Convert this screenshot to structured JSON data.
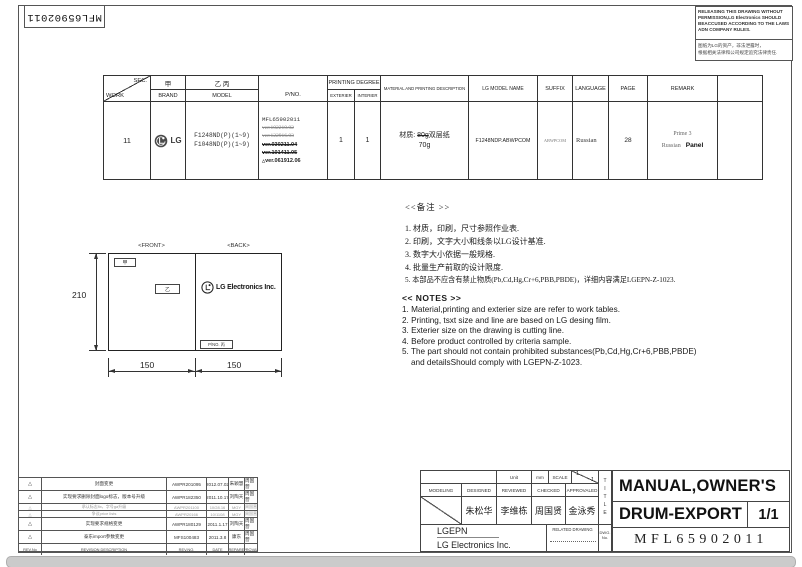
{
  "corner": {
    "pno": "MFL65902011"
  },
  "warning": {
    "english": "RELEASING THIS DRAWING WITHOUT PERMISSION,LG Electronics SHOULD BEACCUSED ACCORDING TO THE LAWS ADN COMPANY RULES.",
    "chinese_line1": "图纸为LG的资产，非法泄露时，",
    "chinese_line2": "根据相关法律和公司规定追究法律责任."
  },
  "work_table": {
    "headers": {
      "sec": "SEC.",
      "work": "WORK",
      "brand_cn": "甲",
      "brand": "BRAND",
      "model_cn": "乙 丙",
      "model": "MODEL",
      "pno": "P/NO.",
      "printing_degree": "PRINTING DEGREE",
      "exterier": "EXTERIER",
      "interier": "INTERIER",
      "material": "MATERIAL AND PRINTING DESCRIPTION",
      "lg_model_name": "LG MODEL NAME",
      "suffix": "SUFFIX",
      "language": "LANGUAGE",
      "page": "PAGE",
      "remark": "REMARK"
    },
    "row": {
      "work": "11",
      "brand": "LG",
      "model_1": "F1248ND(P)(1~9)",
      "model_2": "F1048ND(P)(1~9)",
      "pno": "MFL65902011",
      "versions": [
        {
          "text": "ver:102210.02",
          "struck": true
        },
        {
          "text": "ver:122916.03",
          "struck": true
        },
        {
          "text": "ver.030211.04",
          "struck": true
        },
        {
          "text": "ver.101411.05",
          "struck": true
        },
        {
          "text": "ver.061912.06",
          "struck": false,
          "prefix": "△"
        }
      ],
      "exterier": "1",
      "interier": "1",
      "material_label": "材质:",
      "material_struck": "80g",
      "material_text": "双层纸",
      "material_weight": "70g",
      "lg_model_name": "F1248NDP.ABWPCOM",
      "suffix": "ABWPCOM",
      "language": "Russian",
      "page": "28",
      "remark_line1": "Prime 3",
      "remark_line2_left": "Russian",
      "remark_line2_right": "Panel"
    }
  },
  "diagram": {
    "front_label": "<FRONT>",
    "back_label": "<BACK>",
    "jia": "甲",
    "yi": "乙",
    "logo_text": "LG Electronics Inc.",
    "pno_box": "P/NO. 丙",
    "dim_height": "210",
    "dim_left": "150",
    "dim_right": "150"
  },
  "notes_cn": {
    "title": "<<备注 >>",
    "items": [
      "1. 材质，印刷，尺寸参照作业表.",
      "2. 印刷，文字大小和线条以LG设计基准.",
      "3. 数字大小依据一般规格.",
      "4. 批量生产前取的设计限度.",
      "5. 本部品不应含有禁止物质(Pb,Cd,Hg,Cr+6,PBB,PBDE)，详细内容满足LGEPN-Z-1023."
    ]
  },
  "notes_en": {
    "title": "<< NOTES >>",
    "items": [
      "1. Material,printing and exterier size are refer to work tables.",
      "2. Printing, tsxt  size and line are based on LG desing film.",
      "3. Exterier size on the drawing is cutting line.",
      "4. Before product controlled by criteria sample.",
      "5. The part should not contain prohibited substances(Pb,Cd,Hg,Cr+6,PBB,PBDE)",
      "and detailsShould comply with LGEPN-Z-1023."
    ]
  },
  "revision_table": {
    "headers": {
      "rev_no_col": "REV.No",
      "description": "REVISION DESCRIPTION",
      "rev_no": "REV.NO.",
      "date": "DATE",
      "prepared": "PREPARED",
      "approvaled": "APPROVALED"
    },
    "rows": [
      {
        "sym": "△",
        "desc": "封面变更",
        "no": "AWPR201095",
        "date": "2012.07.02",
        "prep": "朱颖慧",
        "appr": "周国营"
      },
      {
        "sym": "△",
        "desc": "实现要求删除封面logo标志，版本号升级",
        "no": "AWPR182350",
        "date": "2011.10.17",
        "prep": "刘陶天",
        "appr": "周国营"
      },
      {
        "sym": "△",
        "desc": "承认标志fix，字号ga升级",
        "no": "AWPR201100",
        "date": "10/28.16",
        "prep": "MGY",
        "appr": "周国营"
      },
      {
        "sym": "△",
        "desc": "争议price lists",
        "no": "AWPR20166",
        "date": "10/1108",
        "prep": "MGY",
        "appr": "周国营"
      },
      {
        "sym": "△",
        "desc": "实现要求规格变更",
        "no": "AWPR180129",
        "date": "2011.1.17",
        "prep": "刘陶天",
        "appr": "周国营"
      },
      {
        "sym": "△",
        "desc": "泰东import参数变更",
        "no": "MFS100483",
        "date": "2011.3.8",
        "prep": "康东",
        "appr": "周国营"
      }
    ]
  },
  "title_block": {
    "unit_label": "Unit",
    "unit_value": "mm",
    "scale_label": "SCALE",
    "scale_num": "1",
    "scale_den": "1",
    "modeling": "MODELING",
    "designed": "DESIGNED",
    "reviewed": "REVIEWED",
    "checked": "CHECKED",
    "approvaled": "APPROVALED",
    "designed_name": "朱松华",
    "reviewed_name": "李维栋",
    "checked_name": "周国贤",
    "approvaled_name": "金泳秀",
    "company_short": "LGEPN",
    "company_full": "LG Electronics Inc.",
    "related_drawing": "RELATED DRAWING",
    "dwg_no": "DWG. No.",
    "title_vertical": "TITLE",
    "title_line1": "MANUAL,OWNER'S",
    "title_line2": "DRUM-EXPORT",
    "sheet_no": "1/1",
    "drawing_no": "MFL65902011"
  }
}
